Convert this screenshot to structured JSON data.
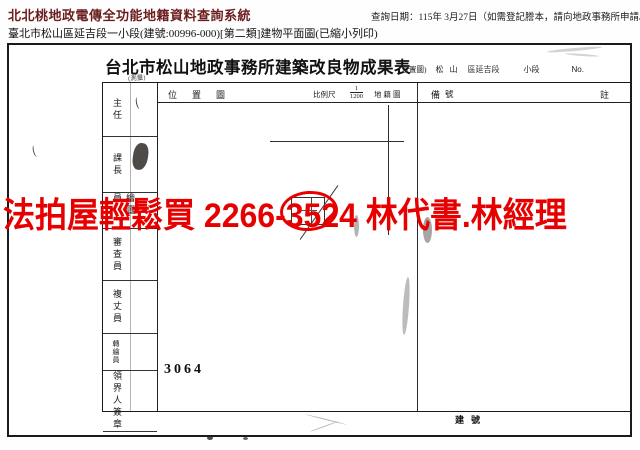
{
  "app": {
    "system_title": "北北桃地政電傳全功能地籍資料查詢系統",
    "query_date": "查詢日期：115年 3月27日（如需登記謄本，請向地政事務所申請。）",
    "doc_info": "臺北市松山區延吉段一小段(建號:00996-000)[第二類]建物平面圖(已縮小列印)"
  },
  "scan": {
    "form_title": "台北市松山地政事務所建築改良物成果表",
    "form_title_annotation": "(測量)",
    "location": {
      "paren_label": "(位置圖)",
      "district": "松山",
      "section_text": "區延吉段",
      "subsection_label": "小段",
      "no_label": "No."
    },
    "header_row": {
      "plan_area_label": "位置圖",
      "scale_label": "比例尺",
      "scale_numerator": "1",
      "scale_denominator": "1200",
      "cadastral_map_label": "地籍圖",
      "number_label": "號",
      "remark_left": "備",
      "remark_right": "註"
    },
    "staff_column": [
      "主任",
      "課長",
      "繪圖員",
      "審查員",
      "複丈員",
      "轉繪員",
      "領界人簽章"
    ],
    "plan_number": "3064",
    "building_no_label": "建號"
  },
  "overlay": {
    "ad_text": "法拍屋輕鬆買 2266-3524 林代書.林經理",
    "ad_color": "#e60000"
  },
  "colors": {
    "system_title": "#6b1d1d",
    "ink": "#1a1a1a",
    "highlight_red": "#e60000"
  }
}
